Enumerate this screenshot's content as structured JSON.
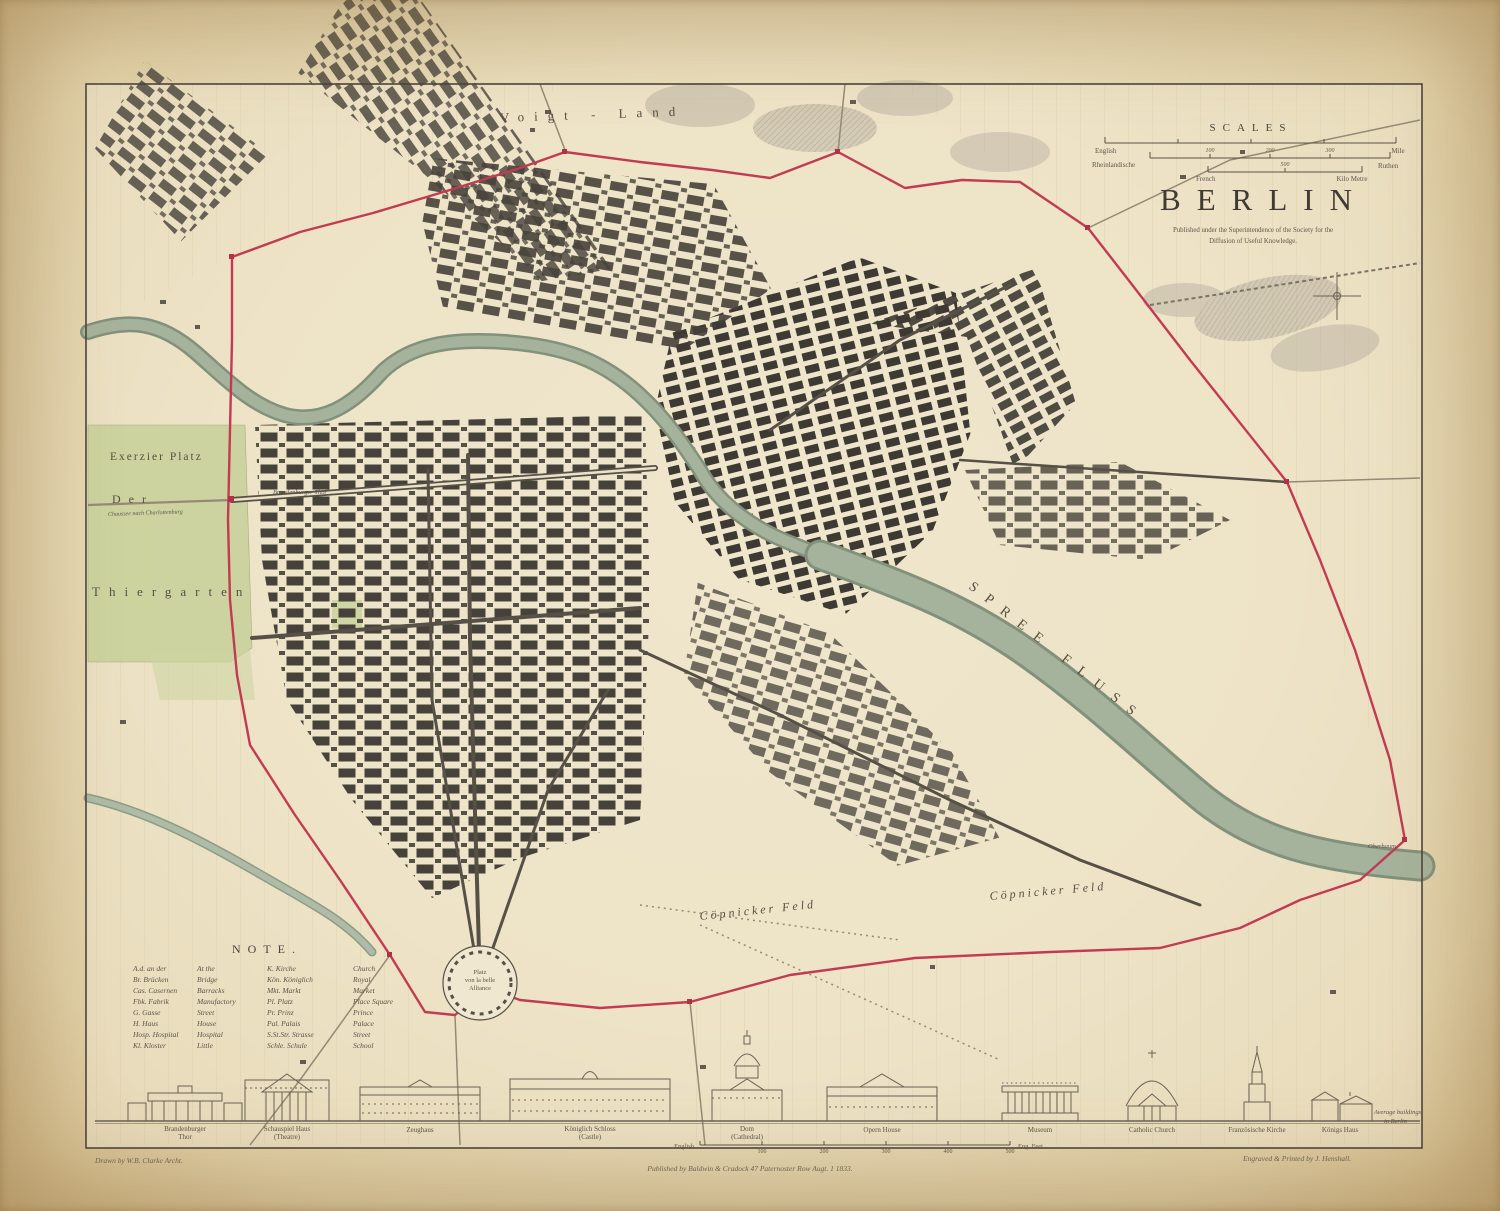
{
  "colors": {
    "paper": "#eadebc",
    "paper_edge": "#cdb483",
    "ink": "#4a443c",
    "street_blocks": "#46413a",
    "boundary_red": "#c23b52",
    "river_green": "#a6b39c",
    "park_green": "#c9d29c",
    "terrain_gray": "#b9b1a3"
  },
  "title_block": {
    "scales_heading": "SCALES",
    "title": "BERLIN",
    "imprint_line1": "Published under the Superintendence of the Society for the",
    "imprint_line2": "Diffusion of Useful Knowledge.",
    "scale_bars": [
      {
        "left_label": "English",
        "right_label": "Mile"
      },
      {
        "left_label": "Rheinlandische",
        "right_label": "Ruthen",
        "numbers": [
          "100",
          "200",
          "300"
        ]
      },
      {
        "left_label": "French",
        "right_label": "Kilo Metre",
        "numbers": [
          "500"
        ]
      }
    ]
  },
  "map_labels": {
    "voigt_land": "Voigt - Land",
    "exerzier_platz": "Exerzier Platz",
    "der": "Der",
    "thiergarten": "Thiergarten",
    "spree_fluss": "SPREE FLUSS",
    "copnicker_feld_west": "Cöpnicker Feld",
    "copnicker_feld_east": "Cöpnicker Feld",
    "platz_line1": "Platz",
    "platz_line2": "von la belle",
    "platz_line3": "Alliance",
    "brandenburger_thor": "Brandenburger Thor",
    "chaussee": "Chaussee nach Charlottenburg",
    "oberbaum": "Oberbaum"
  },
  "note": {
    "heading": "NOTE.",
    "rows": [
      {
        "a": "A.d. an der",
        "am": "At the",
        "b": "K. Kirche",
        "bm": "Church"
      },
      {
        "a": "Br. Brücken",
        "am": "Bridge",
        "b": "Kön. Königlich",
        "bm": "Royal"
      },
      {
        "a": "Cas. Casernen",
        "am": "Barracks",
        "b": "Mkt. Markt",
        "bm": "Market"
      },
      {
        "a": "Fbk. Fabrik",
        "am": "Manufactory",
        "b": "Pl. Platz",
        "bm": "Place Square"
      },
      {
        "a": "G. Gasse",
        "am": "Street",
        "b": "Pr. Prinz",
        "bm": "Prince"
      },
      {
        "a": "H. Haus",
        "am": "House",
        "b": "Pal. Palais",
        "bm": "Palace"
      },
      {
        "a": "Hosp. Hospital",
        "am": "Hospital",
        "b": "S.St.Str. Strasse",
        "bm": "Street"
      },
      {
        "a": "Kl. Kloster",
        "am": "Little",
        "b": "Schle. Schule",
        "bm": "School"
      }
    ]
  },
  "buildings": {
    "items": [
      {
        "line1": "Brandenburger",
        "line2": "Thor"
      },
      {
        "line1": "Schauspiel Haus",
        "line2": "(Theatre)"
      },
      {
        "line1": "Zeughaus",
        "line2": ""
      },
      {
        "line1": "Königlich Schloss",
        "line2": "(Castle)"
      },
      {
        "line1": "Dom",
        "line2": "(Cathedral)"
      },
      {
        "line1": "Opern House",
        "line2": ""
      },
      {
        "line1": "Museum",
        "line2": ""
      },
      {
        "line1": "Catholic Church",
        "line2": ""
      },
      {
        "line1": "Französische Kirche",
        "line2": ""
      },
      {
        "line1": "Königs Haus",
        "line2": ""
      }
    ],
    "side_caption_line1": "Average buildings",
    "side_caption_line2": "in Berlin",
    "feet_scale": {
      "left_label": "English",
      "right_label": "Eng. Feet",
      "ticks": [
        "100",
        "200",
        "300",
        "400",
        "500"
      ]
    }
  },
  "footer": {
    "drawn_by": "Drawn by W.B. Clarke Archt.",
    "published": "Published by Baldwin & Cradock 47 Paternoster Row Augt. 1 1833.",
    "engraved": "Engraved & Printed by J. Henshall."
  }
}
